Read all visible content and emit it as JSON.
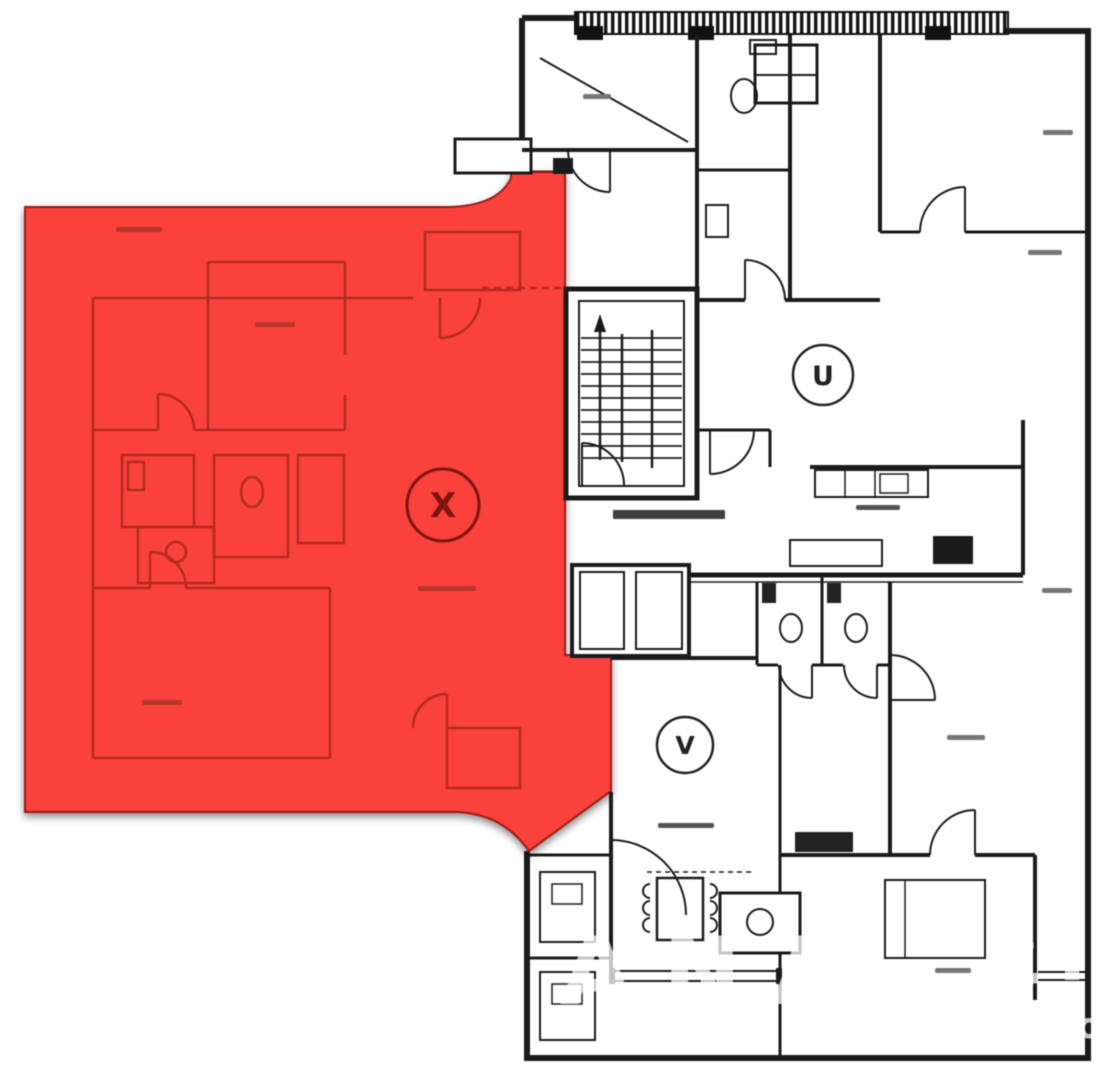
{
  "plan": {
    "units": [
      {
        "label": "X",
        "highlighted": true
      },
      {
        "label": "U",
        "highlighted": false
      },
      {
        "label": "V",
        "highlighted": false
      }
    ],
    "colors": {
      "highlight_fill": "#f8423b",
      "highlight_line": "#b52a21",
      "wall": "#1b1b1b"
    }
  },
  "watermark": {
    "w1": "ANA",
    "w2": "2",
    "w3": "IS",
    "w4": "Imo"
  }
}
